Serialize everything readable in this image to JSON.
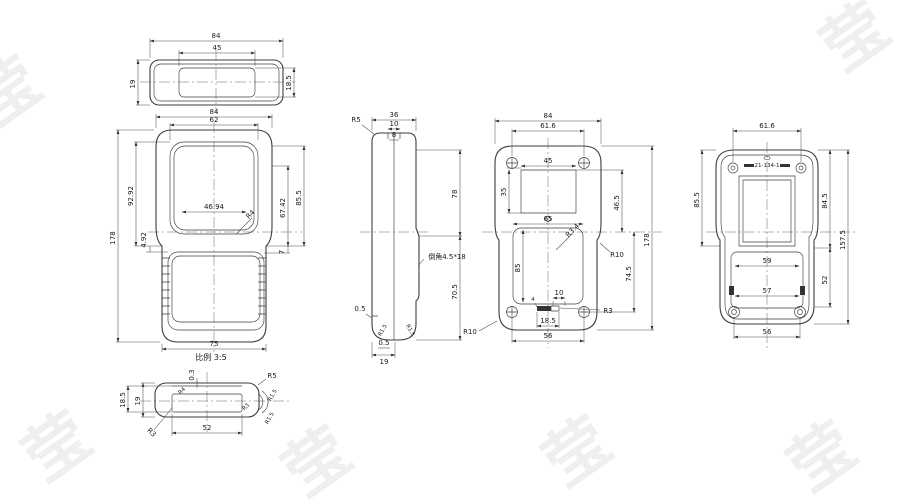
{
  "drawing": {
    "scale_note": "比例 3:5",
    "watermark_char": "莹",
    "colors": {
      "line": "#3c3c3c",
      "text": "#1a1a1a",
      "watermark": "#efefef"
    }
  },
  "top_view": {
    "w84": "84",
    "w45": "45",
    "h19": "19",
    "h18_5": "18.5"
  },
  "front_view": {
    "w84": "84",
    "w62": "62",
    "w46_94": "46.94",
    "h178": "178",
    "h92_92": "92.92",
    "h4_92": "4.92",
    "h67_42": "67.42",
    "h85_5": "85.5",
    "h7": "7",
    "r4": "R4",
    "w75": "75"
  },
  "side_view": {
    "w36": "36",
    "w10": "10",
    "w8": "8",
    "r5": "R5",
    "chamfer": "倒角4.5*18",
    "h78": "78",
    "h70_5": "70.5",
    "t0_5_left": "0.5",
    "r1_5_a": "R1.5",
    "r1_5_b": "R1.5",
    "t0_5_bottom": "0.5",
    "w19": "19"
  },
  "back_view": {
    "w84": "84",
    "w61_6": "61.6",
    "w45": "45",
    "h35": "35",
    "w65": "65",
    "r3_4": "R3.4",
    "h85": "85",
    "h46_5": "46.5",
    "h74_5": "74.5",
    "h178": "178",
    "r10_right": "R10",
    "w10": "10",
    "d4": "4",
    "r3": "R3",
    "w18_5": "18.5",
    "w56": "56",
    "r10_left": "R10"
  },
  "right_view": {
    "w61_6": "61.6",
    "part_no": "21-134-1",
    "h85_5": "85.5",
    "h84_5": "84.5",
    "h52": "52",
    "h157_5": "157.5",
    "w59": "59",
    "w57": "57",
    "w56": "56"
  },
  "detail_view": {
    "t0_3": "0.3",
    "h19": "19",
    "h18_5": "18.5",
    "w52": "52",
    "r5": "R5",
    "r1_5_a": "R1.5",
    "r1_5_b": "R1.5",
    "r3_a": "R3",
    "r4": "R4",
    "r3_b": "R3"
  }
}
